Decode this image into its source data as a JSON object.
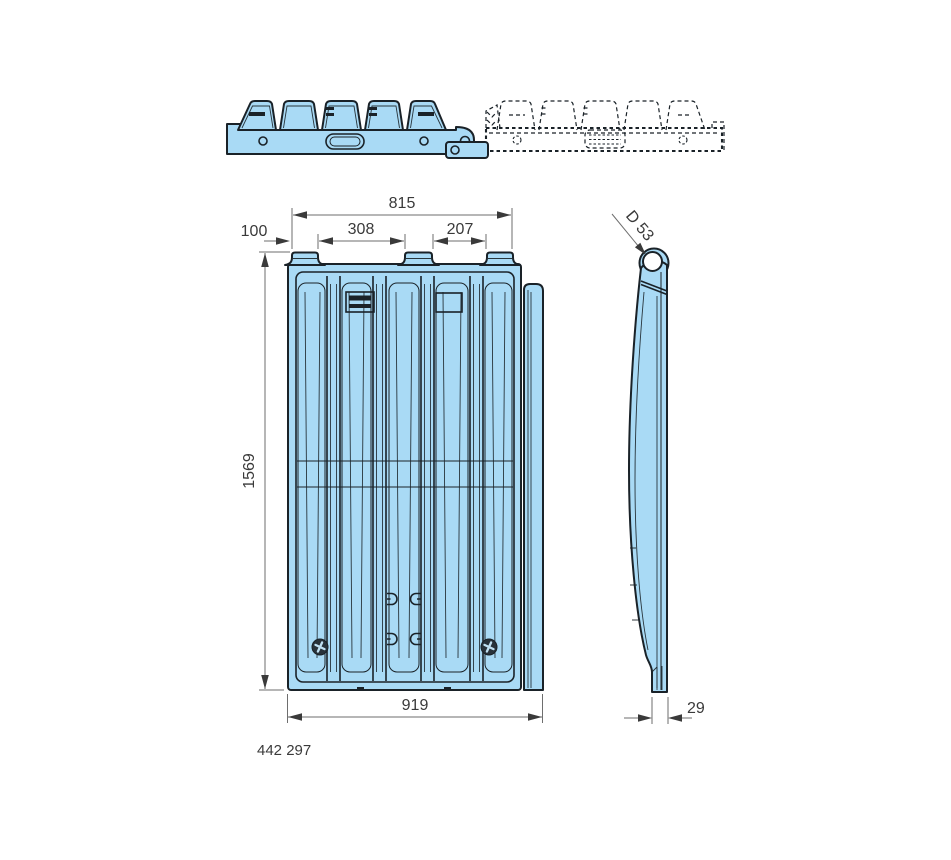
{
  "colors": {
    "part_fill": "#a9daf5",
    "outline": "#1a2228",
    "dim_line": "#6e6e6e",
    "dim_text": "#3a3a3a",
    "screw": "#28323a",
    "screw_slot": "#bfe0f2",
    "background": "#ffffff"
  },
  "labels": {
    "part_number": "442 297",
    "dim_top_overall": "815",
    "dim_tab_width": "100",
    "dim_gap_left": "308",
    "dim_gap_right": "207",
    "dim_height": "1569",
    "dim_bottom_overall": "919",
    "dim_thickness": "29",
    "dim_hinge_hole": "D 53"
  }
}
